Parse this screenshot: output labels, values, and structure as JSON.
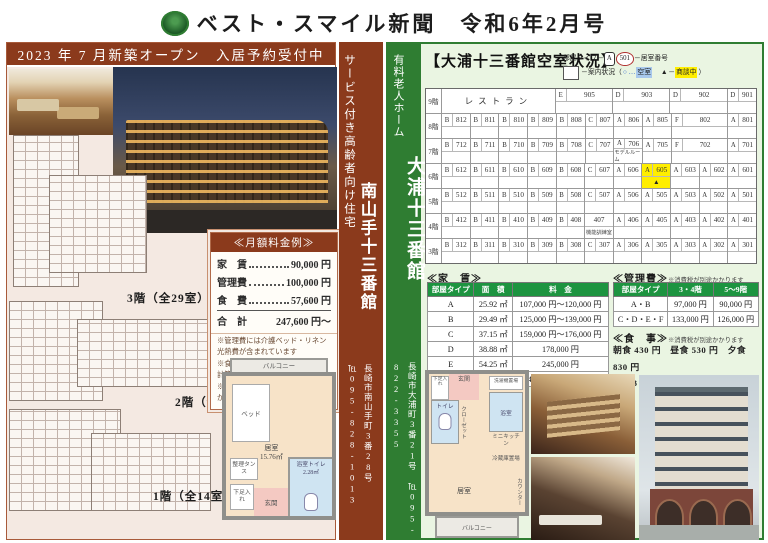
{
  "header": {
    "title": "ベスト・スマイル新聞　令和6年2月号"
  },
  "left": {
    "banner": "2023 年 7 月新築オープン　入居予約受付中",
    "side": {
      "category": "サービス付き高齢者向け住宅",
      "name": "南山手十三番館",
      "address": "長崎市南山手町3番28号",
      "tel": "℡095-828-1013"
    },
    "price_box": {
      "title": "≪月額料金例≫",
      "rows": [
        {
          "label": "家　賃",
          "value": "90,000 円",
          "dots": true
        },
        {
          "label": "管理費",
          "value": "100,000 円",
          "dots": true
        },
        {
          "label": "食　費",
          "value": "57,600 円",
          "dots": true
        },
        {
          "label": "合　計",
          "value": "247,600 円～",
          "dots": false
        }
      ],
      "notes": [
        "※管理費には介護ベッド・リネン　光熱費が含まれています",
        "※食費は１食640円×3食×30日で　計算しています",
        "※別途、介護度に応じて介護費用が　かかります"
      ]
    },
    "floors": [
      "3階（全29室）",
      "2階（全29室）",
      "1階（全14室）"
    ],
    "unit_plan": {
      "balcony": "バルコニー",
      "bed": "ベッド",
      "room": "居室",
      "room_area": "15.76㎡",
      "tansu": "整理タンス",
      "shoes": "下足入れ",
      "entrance": "玄関",
      "bath": "浴室トイレ",
      "bath_area": "2.28㎡"
    }
  },
  "right": {
    "side": {
      "category": "有料老人ホーム",
      "name": "大浦十三番館",
      "address": "長崎市大浦町3番21号",
      "tel": "℡095-822-3355"
    },
    "vacancy": {
      "title": "【大浦十三番館空室状況】",
      "legend": {
        "type_label": "部屋タイプ",
        "dash": "─",
        "sample_type": "A",
        "sample_no": "501",
        "no_label": "居室番号",
        "status_open": "案内状況（",
        "vacant_sym": "○ … ",
        "vacant": "空室",
        "sep": "　",
        "nego_sym": "▲ ─ ",
        "nego": "商談中",
        "status_close": "）"
      },
      "floors": [
        {
          "label": "9階",
          "rooms": [
            {
              "type": "",
              "no": "レストラン",
              "span": 8,
              "hall": true
            },
            {
              "type": "E",
              "no": "905",
              "span": 4
            },
            {
              "type": "D",
              "no": "903",
              "span": 4
            },
            {
              "type": "D",
              "no": "902",
              "span": 4
            },
            {
              "type": "D",
              "no": "901",
              "span": 2
            }
          ]
        },
        {
          "label": "8階",
          "rooms": [
            {
              "type": "B",
              "no": "812"
            },
            {
              "type": "B",
              "no": "811"
            },
            {
              "type": "B",
              "no": "810"
            },
            {
              "type": "B",
              "no": "809"
            },
            {
              "type": "B",
              "no": "808"
            },
            {
              "type": "C",
              "no": "807"
            },
            {
              "type": "A",
              "no": "806"
            },
            {
              "type": "A",
              "no": "805"
            },
            {
              "type": "F",
              "no": "802",
              "span": 4
            },
            {
              "type": "A",
              "no": "801"
            }
          ]
        },
        {
          "label": "7階",
          "rooms": [
            {
              "type": "B",
              "no": "712"
            },
            {
              "type": "B",
              "no": "711"
            },
            {
              "type": "B",
              "no": "710"
            },
            {
              "type": "B",
              "no": "709"
            },
            {
              "type": "B",
              "no": "708"
            },
            {
              "type": "C",
              "no": "707"
            },
            {
              "type": "A",
              "no": "706",
              "note": "モデルルーム"
            },
            {
              "type": "A",
              "no": "705"
            },
            {
              "type": "F",
              "no": "702",
              "span": 4
            },
            {
              "type": "A",
              "no": "701"
            }
          ]
        },
        {
          "label": "6階",
          "rooms": [
            {
              "type": "B",
              "no": "612"
            },
            {
              "type": "B",
              "no": "611"
            },
            {
              "type": "B",
              "no": "610"
            },
            {
              "type": "B",
              "no": "609"
            },
            {
              "type": "B",
              "no": "608"
            },
            {
              "type": "C",
              "no": "607"
            },
            {
              "type": "A",
              "no": "606"
            },
            {
              "type": "A",
              "no": "605",
              "highlight": true,
              "status": "▲"
            },
            {
              "type": "A",
              "no": "603"
            },
            {
              "type": "A",
              "no": "602"
            },
            {
              "type": "A",
              "no": "601"
            }
          ]
        },
        {
          "label": "5階",
          "rooms": [
            {
              "type": "B",
              "no": "512"
            },
            {
              "type": "B",
              "no": "511"
            },
            {
              "type": "B",
              "no": "510"
            },
            {
              "type": "B",
              "no": "509"
            },
            {
              "type": "B",
              "no": "508"
            },
            {
              "type": "C",
              "no": "507"
            },
            {
              "type": "A",
              "no": "506"
            },
            {
              "type": "A",
              "no": "505"
            },
            {
              "type": "A",
              "no": "503"
            },
            {
              "type": "A",
              "no": "502"
            },
            {
              "type": "A",
              "no": "501"
            }
          ]
        },
        {
          "label": "4階",
          "rooms": [
            {
              "type": "B",
              "no": "412"
            },
            {
              "type": "B",
              "no": "411"
            },
            {
              "type": "B",
              "no": "410"
            },
            {
              "type": "B",
              "no": "409"
            },
            {
              "type": "B",
              "no": "408"
            },
            {
              "type": "",
              "no": "407",
              "note": "機能訓練室"
            },
            {
              "type": "A",
              "no": "406"
            },
            {
              "type": "A",
              "no": "405"
            },
            {
              "type": "A",
              "no": "403"
            },
            {
              "type": "A",
              "no": "402"
            },
            {
              "type": "A",
              "no": "401"
            }
          ]
        },
        {
          "label": "3階",
          "rooms": [
            {
              "type": "B",
              "no": "312"
            },
            {
              "type": "B",
              "no": "311"
            },
            {
              "type": "B",
              "no": "310"
            },
            {
              "type": "B",
              "no": "309"
            },
            {
              "type": "B",
              "no": "308"
            },
            {
              "type": "C",
              "no": "307"
            },
            {
              "type": "A",
              "no": "306"
            },
            {
              "type": "A",
              "no": "305"
            },
            {
              "type": "A",
              "no": "303"
            },
            {
              "type": "A",
              "no": "302"
            },
            {
              "type": "A",
              "no": "301"
            }
          ]
        }
      ]
    },
    "rent": {
      "title": "≪家　賃≫",
      "headers": [
        "部屋タイプ",
        "面　積",
        "料　金"
      ],
      "rows": [
        [
          "A",
          "25.92 ㎡",
          "107,000 円～120,000 円"
        ],
        [
          "B",
          "29.49 ㎡",
          "125,000 円～139,000 円"
        ],
        [
          "C",
          "37.15 ㎡",
          "159,000 円～176,000 円"
        ],
        [
          "D",
          "38.88 ㎡",
          "178,000 円"
        ],
        [
          "E",
          "54.25 ㎡",
          "245,000 円"
        ],
        [
          "F",
          "51.84 ㎡",
          "234,000 円～240,000 円"
        ]
      ]
    },
    "kanri": {
      "title": "≪管理費≫",
      "note": "※消費税が別途かかります",
      "headers": [
        "部屋タイプ",
        "3・4階",
        "5～9階"
      ],
      "rows": [
        [
          "A・B",
          "97,000 円",
          "90,000 円"
        ],
        [
          "C・D・E・F",
          "133,000 円",
          "126,000 円"
        ]
      ]
    },
    "meals": {
      "title": "≪食　事≫",
      "note": "※消費税が別途かかります",
      "line1": "朝食 430 円　昼食 530 円　夕食 830 円",
      "line2": "1 日 3 食 30 日ご利用の場合 53,700 円"
    },
    "unit_plan": {
      "shoes": "下足入れ",
      "entrance": "玄関",
      "laundry": "洗濯機置場",
      "toilet": "トイレ",
      "bath": "浴室",
      "closet": "クローゼット",
      "kitchen": "ミニキッチン",
      "fridge": "冷蔵庫置場",
      "counter": "カウンター",
      "room": "居室",
      "balcony": "バルコニー"
    },
    "colors": {
      "maroon": "#8b3a1c",
      "green": "#2f7d32",
      "table_header_green": "#1d9440",
      "highlight_yellow": "#ffee00",
      "vacant_blue": "#a8c8ec"
    }
  }
}
